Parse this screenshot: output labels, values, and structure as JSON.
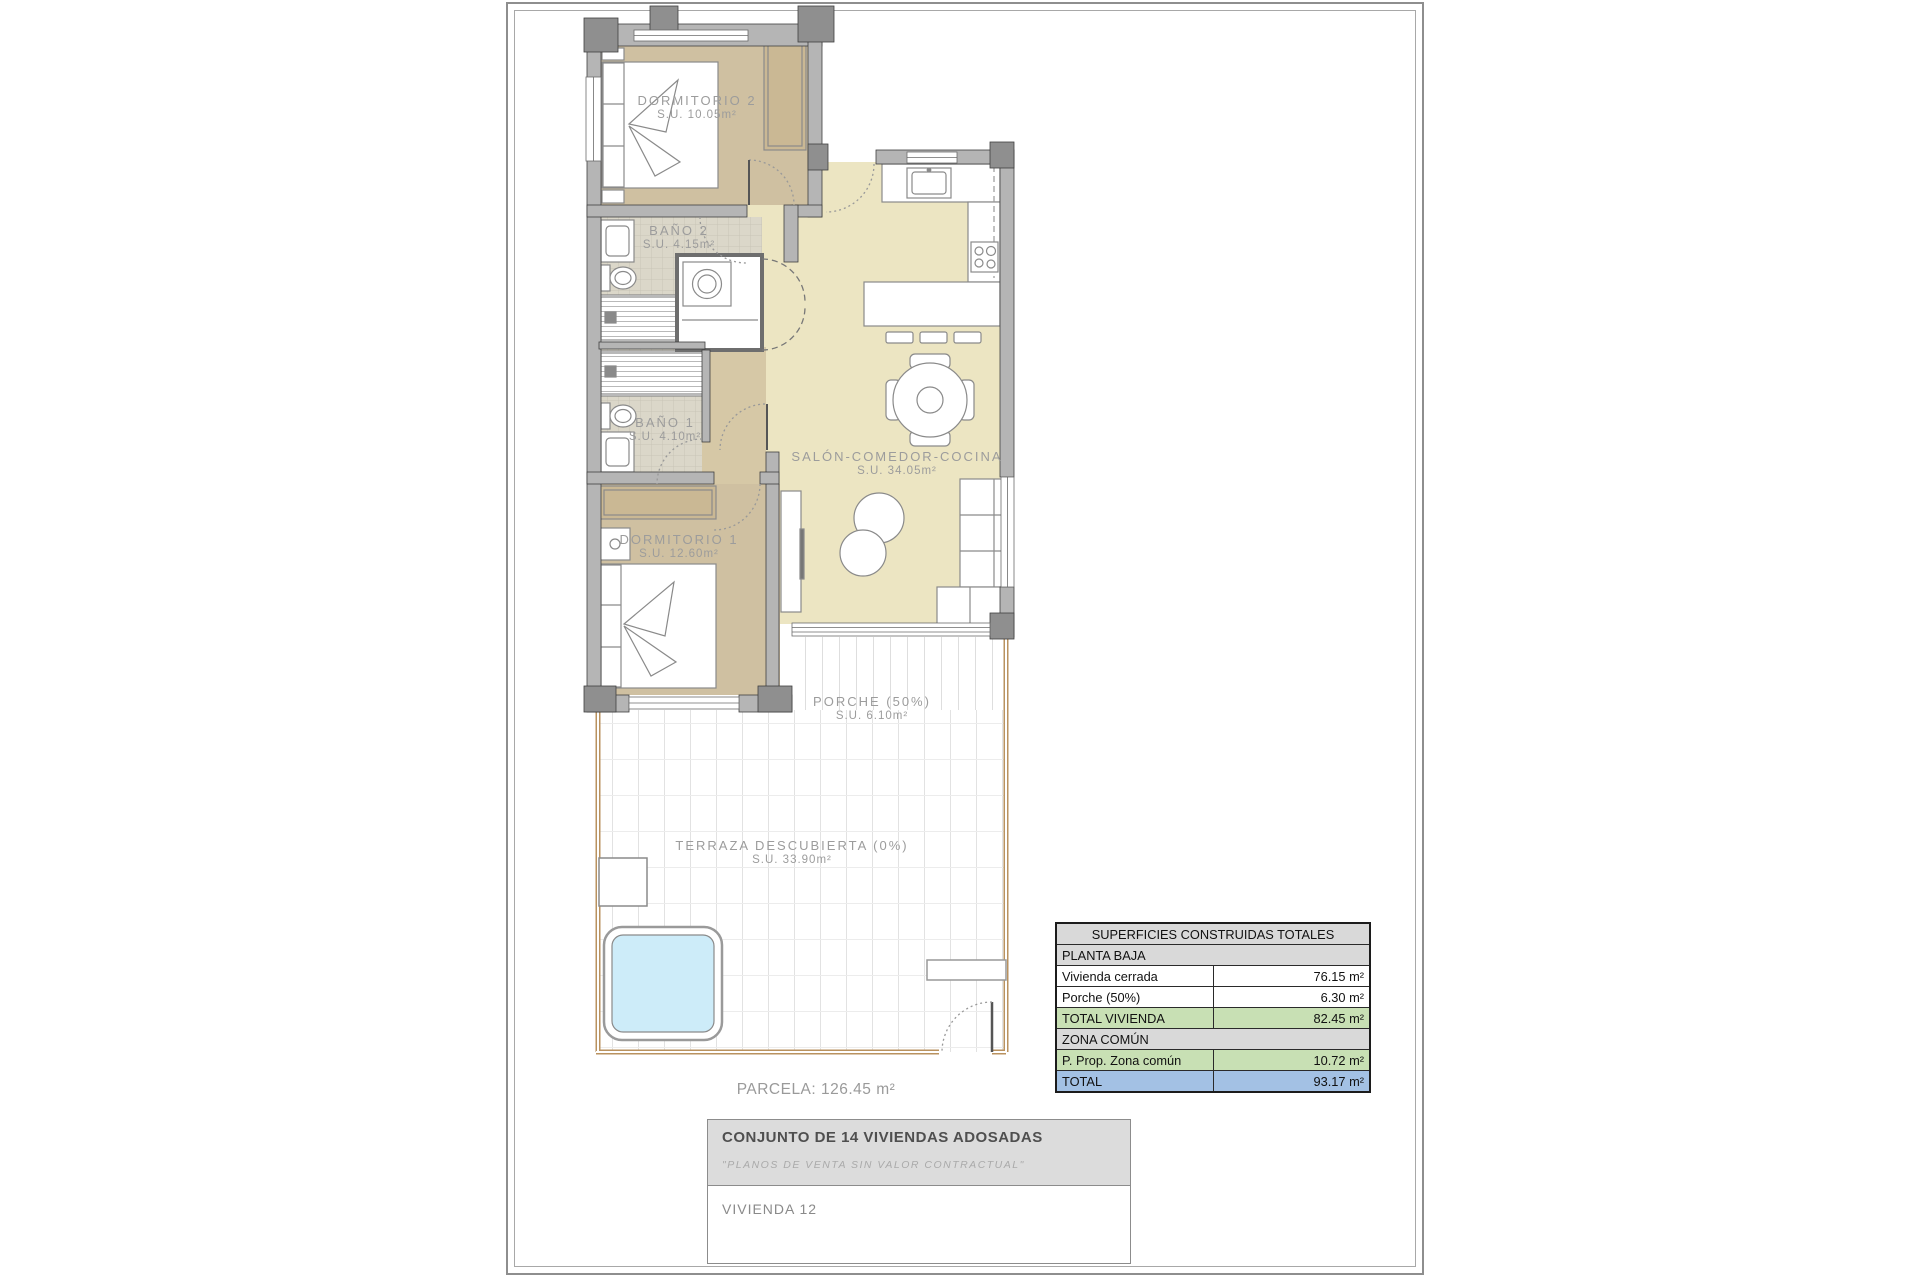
{
  "sheet": {
    "parcela_label": "PARCELA: 126.45 m²"
  },
  "rooms": [
    {
      "id": "dormitorio2",
      "name": "DORMITORIO 2",
      "area": "S.U. 10.05m²"
    },
    {
      "id": "bano2",
      "name": "BAÑO 2",
      "area": "S.U. 4.15m²"
    },
    {
      "id": "bano1",
      "name": "BAÑO 1",
      "area": "S.U. 4.10m²"
    },
    {
      "id": "dormitorio1",
      "name": "DORMITORIO 1",
      "area": "S.U. 12.60m²"
    },
    {
      "id": "salon",
      "name": "SALÓN-COMEDOR-COCINA",
      "area": "S.U. 34.05m²"
    },
    {
      "id": "porche",
      "name": "PORCHE (50%)",
      "area": "S.U. 6.10m²"
    },
    {
      "id": "terraza",
      "name": "TERRAZA DESCUBIERTA (0%)",
      "area": "S.U. 33.90m²"
    }
  ],
  "areas_table": {
    "title": "SUPERFICIES CONSTRUIDAS TOTALES",
    "rows": [
      {
        "label": "PLANTA BAJA",
        "value": "",
        "type": "section"
      },
      {
        "label": "Vivienda cerrada",
        "value": "76.15 m²",
        "type": "normal"
      },
      {
        "label": "Porche (50%)",
        "value": "6.30 m²",
        "type": "normal"
      },
      {
        "label": "TOTAL VIVIENDA",
        "value": "82.45 m²",
        "type": "subtotal"
      },
      {
        "label": "ZONA COMÚN",
        "value": "",
        "type": "section"
      },
      {
        "label": "P. Prop. Zona común",
        "value": "10.72 m²",
        "type": "subtotal"
      },
      {
        "label": "TOTAL",
        "value": "93.17 m²",
        "type": "total"
      }
    ],
    "colors": {
      "section_bg": "#d9d9d9",
      "subtotal_bg": "#c8e0b4",
      "total_bg": "#a3c1e4"
    }
  },
  "title_block": {
    "project": "CONJUNTO DE 14 VIVIENDAS ADOSADAS",
    "disclaimer": "\"PLANOS DE VENTA SIN VALOR CONTRACTUAL\"",
    "unit": "VIVIENDA 12"
  },
  "plan_colors": {
    "wall": "#b5b5b5",
    "bedroom_floor": "#cfc0a1",
    "living_floor": "#ece5c2",
    "bath_floor": "#dbd7c9",
    "corridor_floor": "#d6c8a6",
    "pool_water": "#cdecf9",
    "terrace_boundary": "#b9925f"
  }
}
